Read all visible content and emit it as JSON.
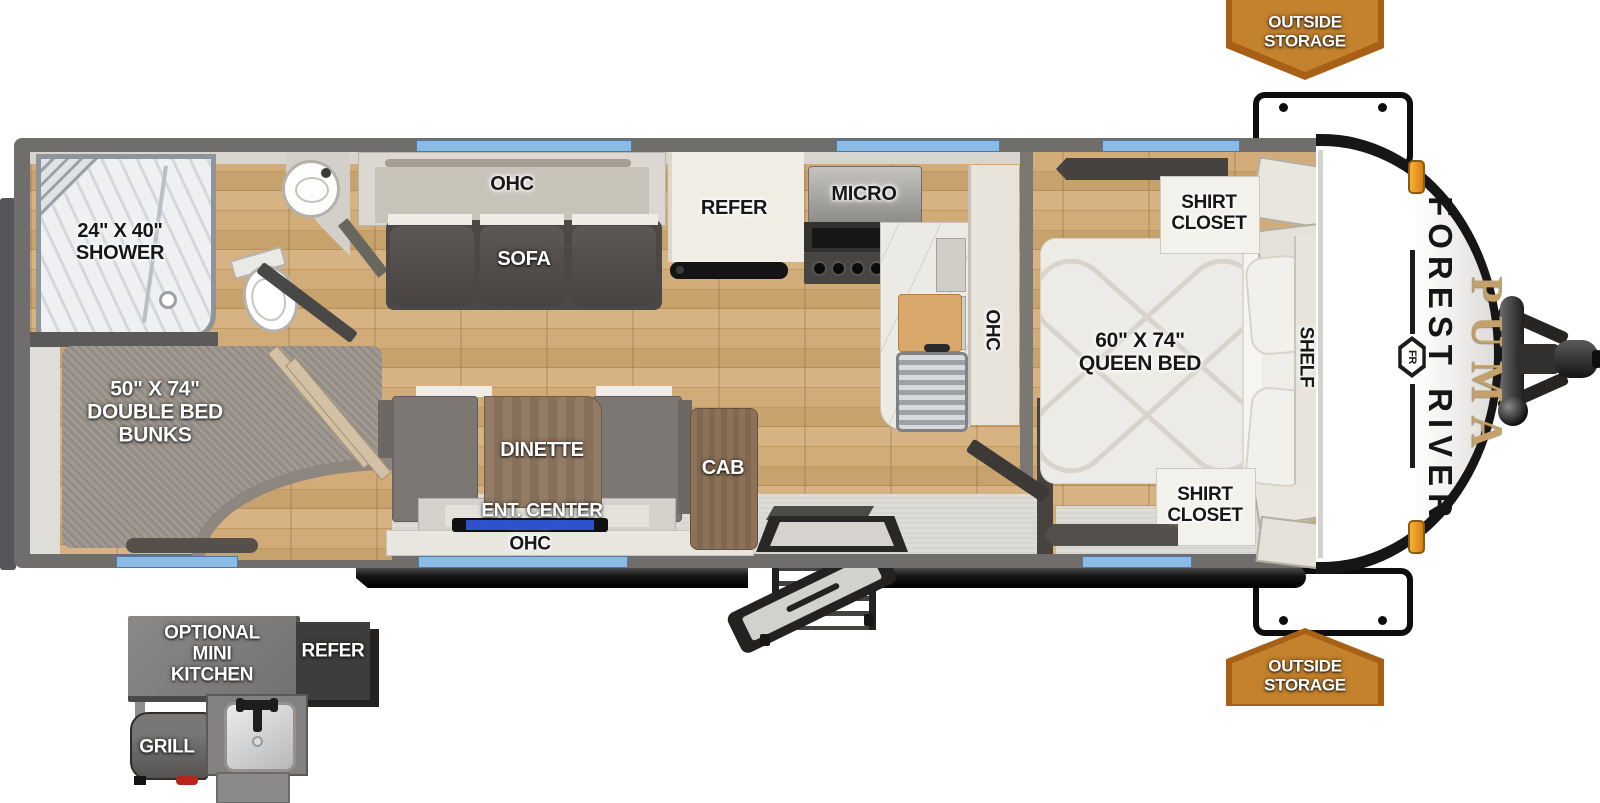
{
  "title": "Forest River Puma travel trailer floorplan",
  "brand": {
    "manufacturer": "FOREST RIVER",
    "model": "PUMA",
    "logo_monogram": "FR"
  },
  "callouts": {
    "outside_storage_top": "OUTSIDE\nSTORAGE",
    "outside_storage_bottom": "OUTSIDE\nSTORAGE"
  },
  "rooms": {
    "bathroom": {
      "shower": "24\" X 40\"\nSHOWER"
    },
    "bunk_room": {
      "bunks": "50\" X 74\"\nDOUBLE BED\nBUNKS"
    },
    "living": {
      "overhead_cabinet": "OHC",
      "sofa": "SOFA",
      "dinette": "DINETTE",
      "entertainment_center": "ENT. CENTER",
      "overhead_cabinet_lower": "OHC",
      "cabinet": "CAB"
    },
    "kitchen": {
      "refrigerator": "REFER",
      "microwave": "MICRO",
      "overhead_cabinet": "OHC"
    },
    "bedroom": {
      "shirt_closet_top": "SHIRT\nCLOSET",
      "bed": "60\" X 74\"\nQUEEN BED",
      "shelf": "SHELF",
      "shirt_closet_bottom": "SHIRT\nCLOSET"
    }
  },
  "exterior_options": {
    "mini_kitchen": "OPTIONAL\nMINI KITCHEN",
    "refrigerator": "REFER",
    "grill": "GRILL"
  },
  "colors": {
    "banner_fill": "#c4822d",
    "banner_border": "#a86016",
    "window_blue": "#8abbe6",
    "wall_gray": "#6f6e6c",
    "wood_floor": "#c8a26c",
    "tv_accent_blue": "#2d52cc",
    "puma_gold": "#c3a06c",
    "marker_amber": "#f0a030"
  }
}
